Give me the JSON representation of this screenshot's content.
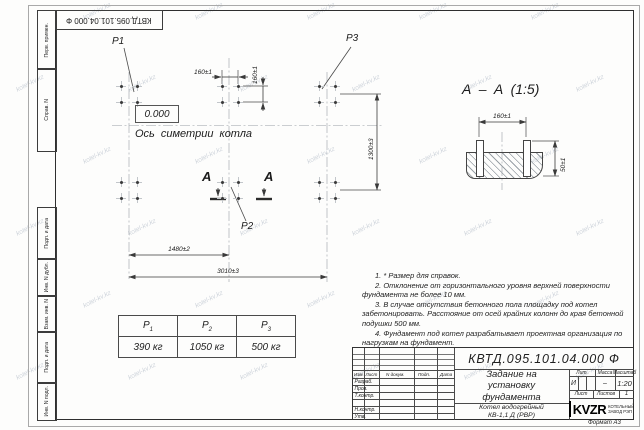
{
  "watermark": "kotel-kv.kz",
  "stamp_top": "КВТД.095.101.04.000 Ф",
  "margin_boxes": [
    "Перв. примен.",
    "Справ. N",
    "Подп. и дата",
    "Инв. N дубл.",
    "Взам. инв. N",
    "Подп. и дата",
    "Инв. N подл."
  ],
  "plan": {
    "elevation": "0.000",
    "axis_label": "Ось симетрии котла",
    "p1": "P1",
    "p2": "P2",
    "p3": "P3",
    "section_letter_left": "A",
    "section_letter_right": "A",
    "dim_160_h": "160±1",
    "dim_160_v": "160±1",
    "dim_1480": "1480±2",
    "dim_3010": "3010±3",
    "dim_1300": "1300±3"
  },
  "section_view": {
    "title": "A – A (1:5)",
    "dim_width": "160±1",
    "dim_height": "50±1"
  },
  "load_table": {
    "headers": [
      {
        "label": "P",
        "sub": "1"
      },
      {
        "label": "P",
        "sub": "2"
      },
      {
        "label": "P",
        "sub": "3"
      }
    ],
    "values": [
      "390 кг",
      "1050 кг",
      "500 кг"
    ]
  },
  "notes": [
    "1. * Размер для справок.",
    "2. Отклонение от горизонтального уровня верхней поверхности фундамента не более 10 мм.",
    "3. В случае отсутствия бетонного пола площадку под котел забетонировать. Расстояние от осей крайних колонн до края бетонной подушки 500 мм.",
    "4. Фундамент под котел разрабатывает проектная организация по нагрузкам на фундамент."
  ],
  "title_block": {
    "doc_number": "КВТД.095.101.04.000 Ф",
    "title": "Задание на установку фундамента",
    "col_izm": "Изм.",
    "col_list": "Лист",
    "col_doc": "N докум.",
    "col_podp": "Подп.",
    "col_date": "Дата",
    "row_razrab": "Разраб.",
    "row_prov": "Пров.",
    "row_tkontr": "Т.контр.",
    "row_nkontr": "Н.контр.",
    "row_utv": "Утв.",
    "lit_label": "Лит.",
    "mass_label": "Масса",
    "scale_label": "Масштаб",
    "lit_value": "И",
    "mass_value": "–",
    "scale_value": "1:20",
    "sheet_label": "Лист",
    "sheets_label": "Листов",
    "sheets_value": "1",
    "product_line1": "Котел водогрейный",
    "product_line2": "КВ-1,1 Д (РВР)",
    "company": "KVZR",
    "company_sub1": "КОТЕЛЬНЫЙ",
    "company_sub2": "ЗАВОД РЭП",
    "format": "Формат А3"
  }
}
